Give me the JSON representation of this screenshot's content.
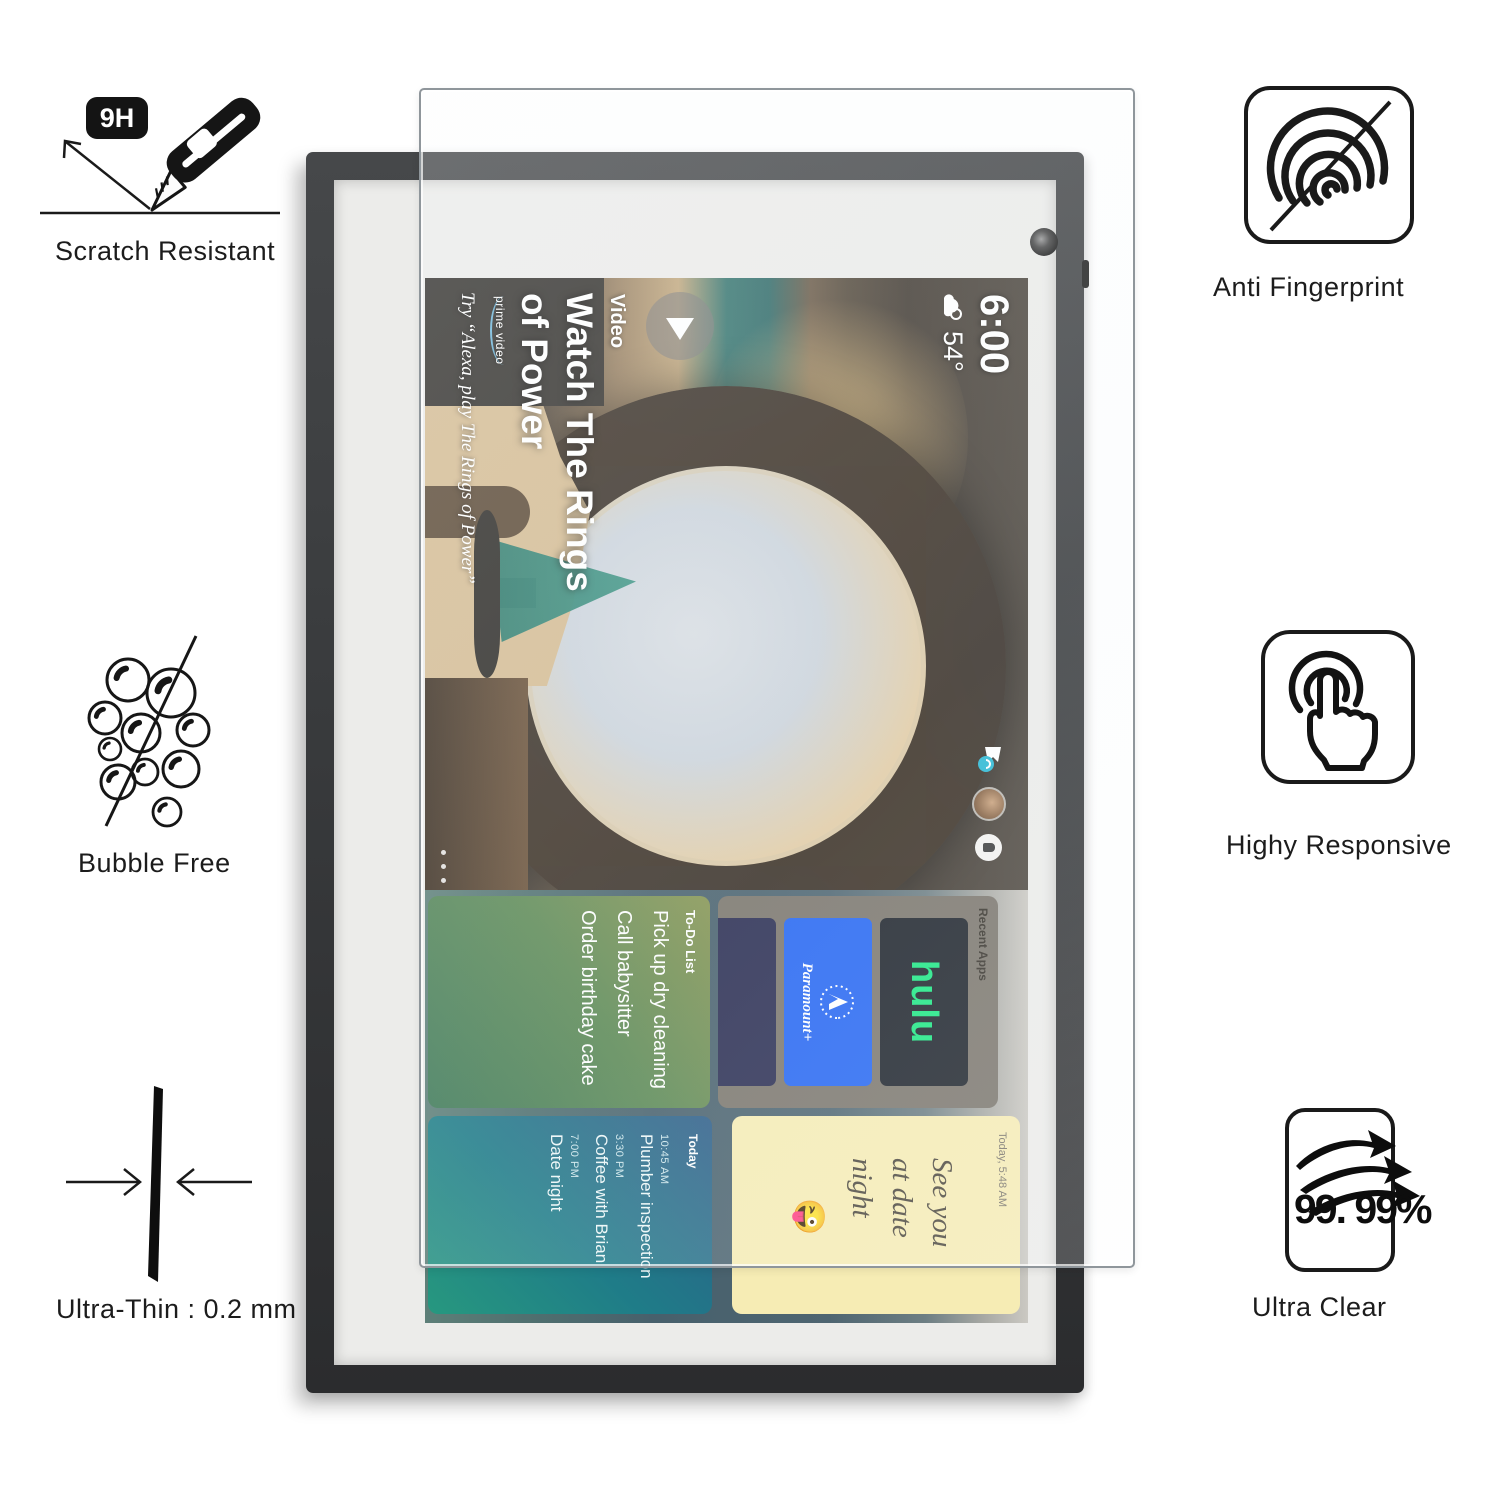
{
  "callouts": {
    "scratch_resistant": {
      "badge": "9H",
      "label": "Scratch Resistant"
    },
    "anti_fingerprint": {
      "label": "Anti Fingerprint"
    },
    "bubble_free": {
      "label": "Bubble Free"
    },
    "highly_responsive": {
      "label": "Highy Responsive"
    },
    "ultra_thin": {
      "label": "Ultra-Thin : 0.2 mm"
    },
    "ultra_clear": {
      "label": "Ultra Clear",
      "value": "99. 99%"
    }
  },
  "device_screen": {
    "status": {
      "time": "6:00",
      "temperature": "54°"
    },
    "banner": {
      "category": "Video",
      "title_line1": "Watch The Rings",
      "title_line2": "of Power",
      "brand": "prime video",
      "hint": "Try “Alexa, play The Rings of Power”"
    },
    "widgets": {
      "recent_apps": {
        "label": "Recent Apps",
        "app1": "hulu",
        "app2": "Paramount+"
      },
      "todo": {
        "title": "To-Do List",
        "item1": "Pick up dry cleaning",
        "item2": "Call babysitter",
        "item3": "Order birthday cake"
      },
      "sticky_note": {
        "timestamp": "Today, 5:48 AM",
        "line1": "See you",
        "line2": "at date",
        "line3": "night",
        "emoji": "😜"
      },
      "calendar": {
        "title": "Today",
        "event1_time": "10:45 AM",
        "event1_name": "Plumber inspection",
        "event2_time": "3:30 PM",
        "event2_name": "Coffee with Brian",
        "event3_time": "7:00 PM",
        "event3_name": "Date night"
      }
    }
  }
}
